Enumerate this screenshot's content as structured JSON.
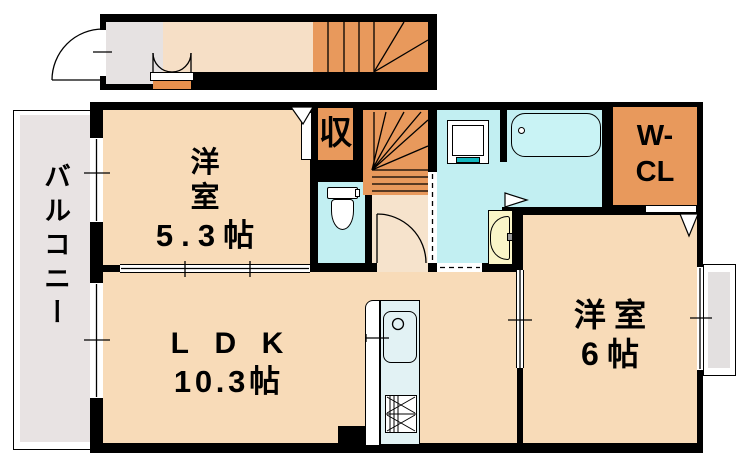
{
  "floor_plan": {
    "rooms": {
      "western_room_1": {
        "name": "洋室",
        "size": "5.3帖"
      },
      "ldk": {
        "name": "LDK",
        "size": "10.3帖"
      },
      "western_room_2": {
        "name": "洋室",
        "size": "6帖"
      },
      "closet": {
        "name": "収"
      },
      "walk_in_closet": {
        "line1": "W-",
        "line2": "CL"
      },
      "balcony": {
        "name": "バルコニー"
      }
    },
    "colors": {
      "wall": "#000000",
      "room_floor": "#F8DBB8",
      "hall_floor": "#F6E3CC",
      "corridor_floor": "#F6DFC6",
      "stairs_and_closet": "#E8995C",
      "wet_area": "#C2EFF2",
      "kitchen_counter": "#E2F2F4",
      "washbasin": "#FAF5C8",
      "teal_accent": "#12B7BE",
      "balcony_gray": "#E8E3E3",
      "entry_gray": "#E6E2E2"
    }
  }
}
